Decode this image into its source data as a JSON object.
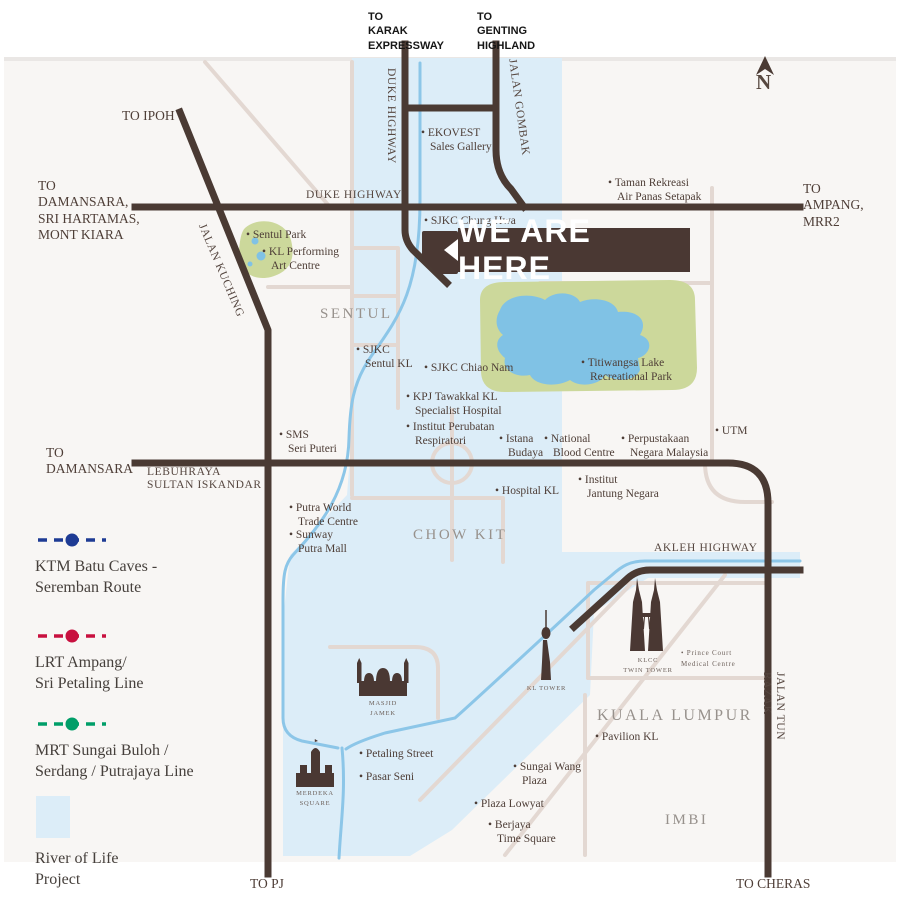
{
  "banner": {
    "text": "WE ARE HERE"
  },
  "compass": {
    "label": "N"
  },
  "top_exits": {
    "karak": "TO\nKARAK\nEXPRESSWAY",
    "genting": "TO\nGENTING\nHIGHLAND"
  },
  "exits": {
    "ipoh": "TO IPOH",
    "damansara_multi": "TO\nDAMANSARA,\nSRI HARTAMAS,\nMONT KIARA",
    "ampang": "TO\nAMPANG,\nMRR2",
    "damansara": "TO\nDAMANSARA",
    "pj": "TO PJ",
    "cheras": "TO CHERAS"
  },
  "roads": {
    "duke_highway_v": "DUKE HIGHWAY",
    "duke_highway_h": "DUKE HIGHWAY",
    "jalan_gombak": "JALAN GOMBAK",
    "jalan_kuching": "JALAN KUCHING",
    "lebuhraya_sultan_iskandar": "LEBUHRAYA\nSULTAN ISKANDAR",
    "akleh_highway": "AKLEH HIGHWAY",
    "jalan_tun_razak": "JALAN TUN RAZAK"
  },
  "districts": {
    "sentul": "SENTUL",
    "chow_kit": "CHOW KIT",
    "kuala_lumpur": "KUALA LUMPUR",
    "imbi": "IMBI"
  },
  "places": {
    "ekovest": "• EKOVEST\nSales Gallery",
    "taman_rekreasi": "• Taman Rekreasi\nAir Panas Setapak",
    "sjkc_chung_hwa": "• SJKC Chung Hwa",
    "sentul_park": "• Sentul Park",
    "kl_performing": "• KL Performing\nArt Centre",
    "sjkc_sentul": "• SJKC\nSentul KL",
    "sjkc_chiao_nam": "• SJKC Chiao Nam",
    "titiwangsa": "• Titiwangsa Lake\nRecreational Park",
    "kpj_tawakkal": "• KPJ Tawakkal KL\nSpecialist Hospital",
    "institut_perubatan": "• Institut Perubatan\nRespiratori",
    "istana_budaya": "• Istana\nBudaya",
    "national_blood": "• National\nBlood Centre",
    "perpustakaan": "• Perpustakaan\nNegara Malaysia",
    "utm": "• UTM",
    "sms_seri_puteri": "• SMS\nSeri Puteri",
    "hospital_kl": "• Hospital KL",
    "institut_jantung": "• Institut\nJantung Negara",
    "putra_world": "• Putra World\nTrade Centre",
    "sunway_putra": "• Sunway\nPutra Mall",
    "pavilion": "• Pavilion KL",
    "petaling_street": "• Petaling Street",
    "pasar_seni": "• Pasar Seni",
    "sungai_wang": "• Sungai Wang\nPlaza",
    "plaza_lowyat": "• Plaza Lowyat",
    "berjaya": "• Berjaya\nTime Square"
  },
  "landmarks": {
    "klcc": "KLCC\nTWIN TOWER",
    "kl_tower": "KL TOWER",
    "masjid_jamek": "MASJID JAMEK",
    "merdeka_square": "MERDEKA\nSQUARE",
    "prince_court": "• Prince Court\nMedical Centre"
  },
  "legend": {
    "ktm": {
      "label": "KTM Batu Caves -\nSeremban Route",
      "color": "#1e3b94"
    },
    "lrt": {
      "label": "LRT Ampang/\nSri Petaling Line",
      "color": "#c8103f"
    },
    "mrt": {
      "label": "MRT Sungai Buloh /\nSerdang / Putrajaya Line",
      "color": "#009e68"
    },
    "river": {
      "label": "River of Life\nProject",
      "color": "#dcedf8"
    }
  },
  "colors": {
    "road_major": "#4a3a33",
    "road_minor": "#e3d8d2",
    "river_line": "#8cc6e8",
    "river_fill": "#dcedf8",
    "park": "#ccd89b",
    "lake": "#80c2e5",
    "banner_bg": "#4a3833"
  }
}
